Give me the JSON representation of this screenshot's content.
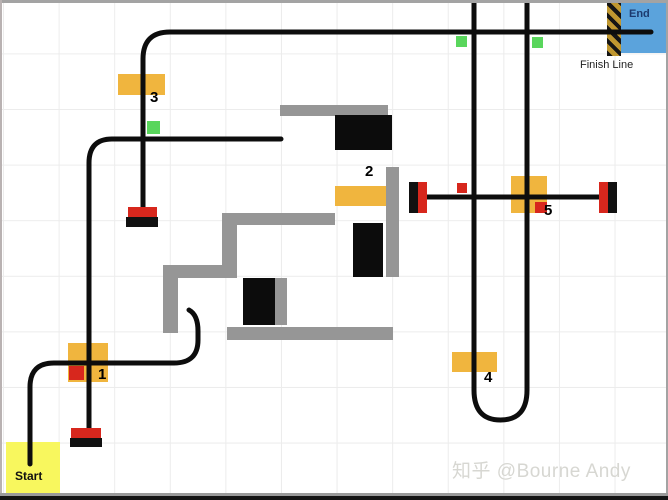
{
  "map": {
    "start_label": "Start",
    "end_label": "End",
    "finish_line_label": "Finish Line",
    "checkpoints": [
      {
        "id": "1"
      },
      {
        "id": "2"
      },
      {
        "id": "3"
      },
      {
        "id": "4"
      },
      {
        "id": "5"
      }
    ],
    "watermark": "知乎 @Bourne Andy",
    "legend_colors": {
      "checkpoint_orange": "#f0b53e",
      "start_yellow": "#f8f75e",
      "end_blue": "#5ba3dc",
      "marker_green": "#59d65c",
      "marker_red": "#d7271d",
      "wall_gray": "#969696",
      "obstacle_black": "#0c0c0c",
      "track_black": "#0d0d0d",
      "finish_hatch_gold": "#bf9730"
    }
  }
}
